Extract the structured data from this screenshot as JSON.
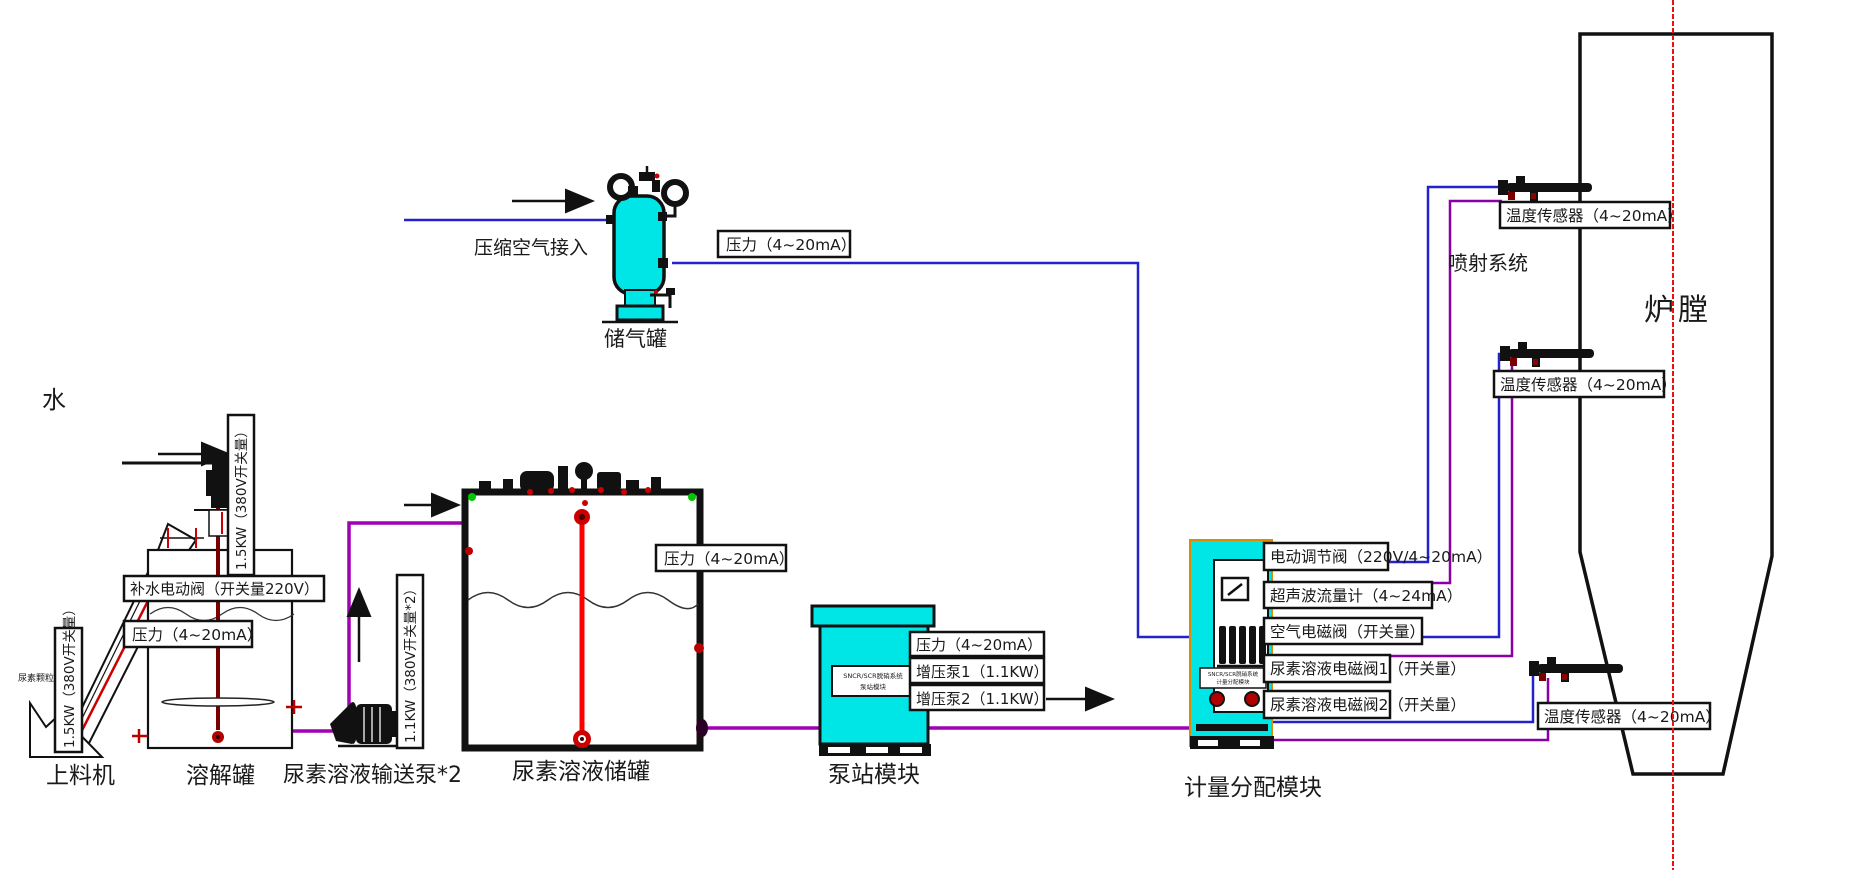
{
  "colors": {
    "equipment_cyan": "#00e6e6",
    "wire_blue": "#2222cf",
    "wire_purple": "#8800a6",
    "pipe_purple": "#a100b4",
    "centerline_red": "#ee1111",
    "valve_dark_red": "#b00000",
    "fitting_green": "#00c800"
  },
  "water_label": "水",
  "feeder": {
    "name": "上料机",
    "power": "1.5KW（380V开关量）",
    "material": "尿素颗粒"
  },
  "dissolving_tank": {
    "name": "溶解罐",
    "fill_valve": "补水电动阀（开关量220V）",
    "pressure": "压力（4~20mA）",
    "mixer_power": "1.5KW（380V开关量）"
  },
  "transfer_pump": {
    "name": "尿素溶液输送泵*2",
    "power": "1.1KW（380V开关量*2）"
  },
  "storage_tank": {
    "name": "尿素溶液储罐",
    "pressure": "压力（4~20mA）"
  },
  "air_system": {
    "inlet_label": "压缩空气接入",
    "tank_name": "储气罐",
    "pressure": "压力（4~20mA）"
  },
  "pump_station": {
    "name": "泵站模块",
    "pressure": "压力（4~20mA）",
    "booster1": "增压泵1（1.1KW）",
    "booster2": "增压泵2（1.1KW）",
    "nameplate_line1": "SNCR/SCR脱硝系统",
    "nameplate_line2": "泵站模块"
  },
  "metering_module": {
    "name": "计量分配模块",
    "nameplate_line1": "SNCR/SCR脱硝系统",
    "nameplate_line2": "计量分配模块",
    "rows": [
      {
        "label": "电动调节阀（220V/4~20mA）"
      },
      {
        "label": "超声波流量计（4~24mA）"
      },
      {
        "label": "空气电磁阀（开关量）"
      },
      {
        "label": "尿素溶液电磁阀1（开关量）"
      },
      {
        "label": "尿素溶液电磁阀2（开关量）"
      }
    ]
  },
  "injection_system": {
    "name": "喷射系统",
    "furnace": "炉膛",
    "sensor1": "温度传感器（4~20mA）",
    "sensor2": "温度传感器（4~20mA）",
    "sensor3": "温度传感器（4~20mA）"
  }
}
